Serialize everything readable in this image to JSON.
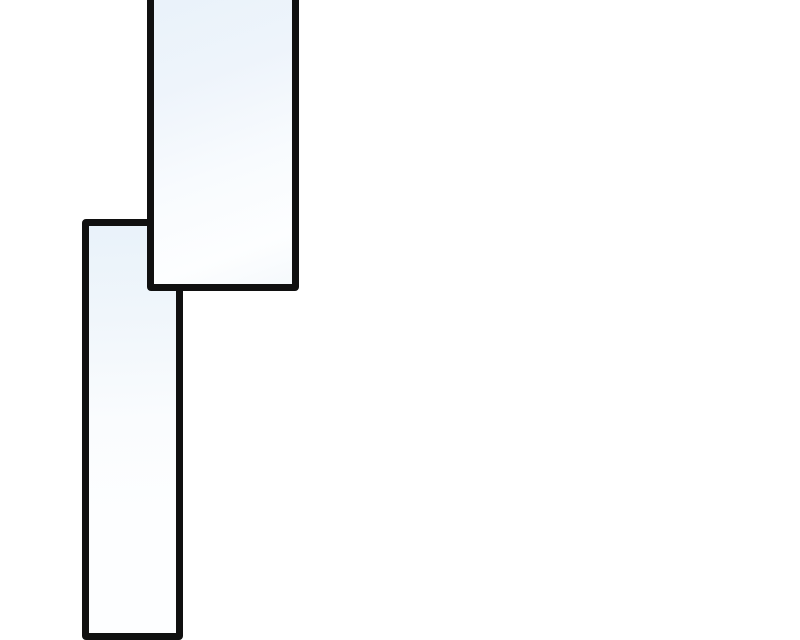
{
  "page": {
    "kind": "blank comic page segment",
    "panel_count": 2
  },
  "theme": {
    "page_bg": "#ffffff",
    "panel_border": "#101010",
    "panel_fill_blue": "#e9f2fa",
    "panel_fill_white": "#fdfeff"
  },
  "panels": [
    {
      "id": "upper",
      "content": ""
    },
    {
      "id": "lower",
      "content": ""
    }
  ]
}
